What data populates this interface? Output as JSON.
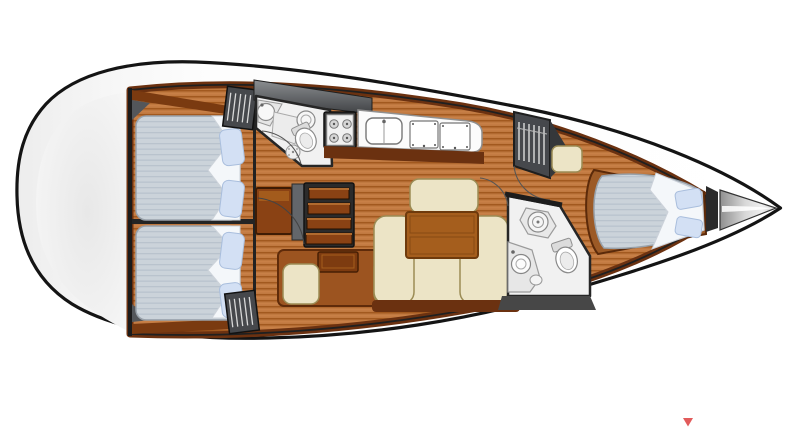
{
  "page": {
    "background": "#ffffff"
  },
  "colors": {
    "hull_stroke": "#141414",
    "wood_base": "#c07940",
    "wood_stripe": "#a2591f",
    "wood_dark_trim": "#6b3110",
    "furniture_brown": "#9c5420",
    "steps_brown": "#8a4214",
    "table_brown": "#a55e1d",
    "cream": "#ece4c6",
    "cream_border": "#9b8c55",
    "mattress_base": "#cbd3da",
    "mattress_stripe": "#b9c3cd",
    "bedding_white": "#f4f7fa",
    "pillow_blue": "#d3e0f4",
    "pillow_border": "#a9bedd",
    "bath_floor": "#f1f1f1",
    "locker_gray": "#46484c",
    "bulkhead_dark": "#222222",
    "marker_red": "#e25b5b"
  },
  "vessel": {
    "type": "sailing-yacht-interior-floor-plan",
    "orientation": "bow-right",
    "regions": [
      {
        "id": "aft-cabin-top",
        "kind": "double-berth-cabin",
        "pillows": 2
      },
      {
        "id": "aft-cabin-bottom",
        "kind": "double-berth-cabin",
        "pillows": 2
      },
      {
        "id": "aft-head",
        "kind": "bathroom",
        "fixtures": [
          "sink",
          "shower",
          "toilet"
        ]
      },
      {
        "id": "companionway",
        "kind": "steps",
        "treads": 4
      },
      {
        "id": "nav-station",
        "kind": "chart-table-with-seat"
      },
      {
        "id": "galley",
        "kind": "kitchen",
        "stove_burners": 4,
        "sink_basins": 1,
        "counter_lids": 2
      },
      {
        "id": "saloon",
        "kind": "u-shaped-settee-with-table"
      },
      {
        "id": "wardrobe",
        "kind": "hanging-locker",
        "hangers": 6
      },
      {
        "id": "forward-head",
        "kind": "bathroom",
        "fixtures": [
          "shower",
          "toilet",
          "sink"
        ]
      },
      {
        "id": "forward-cabin",
        "kind": "v-berth-cabin",
        "pillows": 2
      },
      {
        "id": "bow-locker",
        "kind": "anchor-locker"
      }
    ],
    "marker": {
      "shape": "small-red-triangle-down",
      "x": 688,
      "y": 422
    }
  }
}
